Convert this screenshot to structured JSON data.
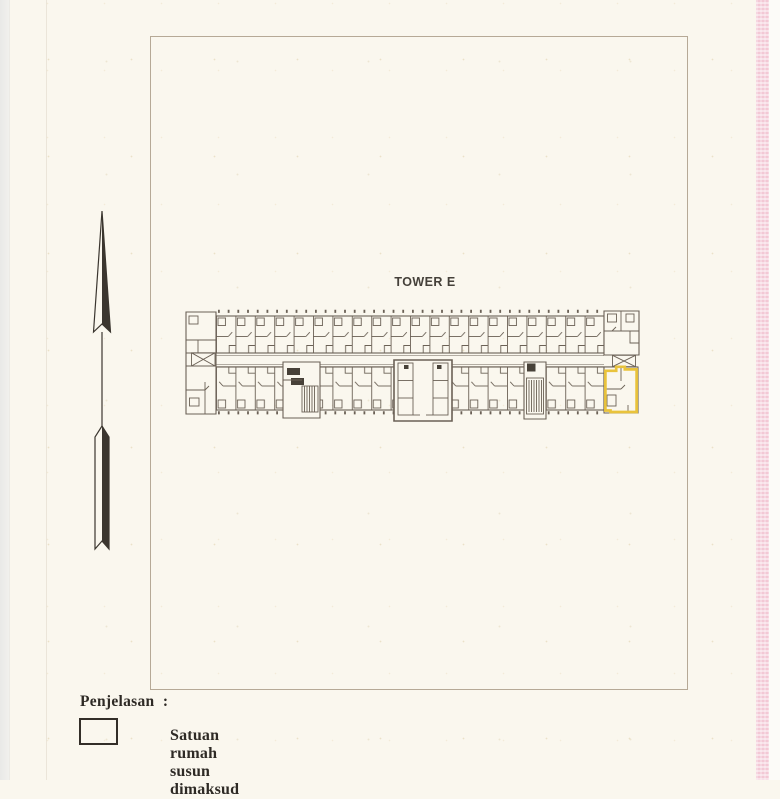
{
  "plan": {
    "title": "TOWER E",
    "highlight": {
      "element": "highlighted-unit",
      "color": "#e9c33c",
      "location": "right end unit of lower row"
    }
  },
  "legend": {
    "heading": "Penjelasan  :",
    "items": [
      {
        "swatch": "outlined-rectangle",
        "label": "Satuan rumah susun dimaksud"
      }
    ]
  },
  "icons": {
    "north_arrow": "north-arrow-icon"
  },
  "colors": {
    "paper": "#faf7ee",
    "plan_line": "#6b6156",
    "plan_dark_fill": "#474138",
    "highlight_yellow": "#e9c33c",
    "frame_border": "#b6a996",
    "text_dark": "#2e2a25",
    "scan_edge_left": "#e9e9e7",
    "scan_edge_right_pink": "#f3c8d5"
  }
}
